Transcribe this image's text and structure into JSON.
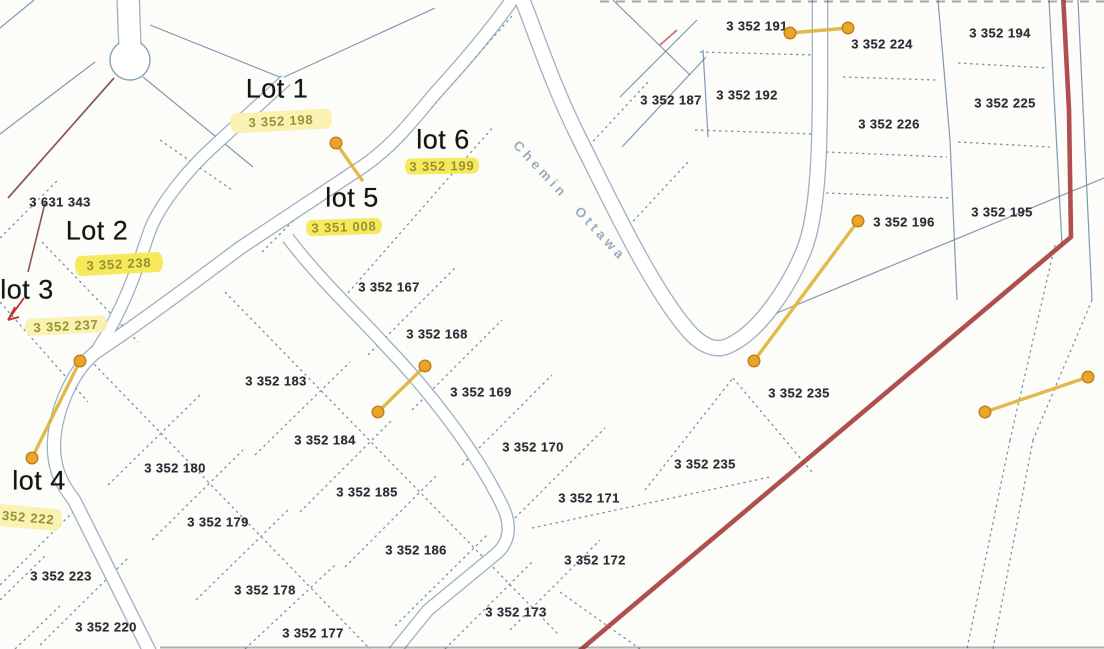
{
  "map": {
    "street_label": "Chemin Ottawa",
    "lot_labels": [
      {
        "text": "Lot 1",
        "x": 277,
        "y": 89
      },
      {
        "text": "Lot 2",
        "x": 97,
        "y": 231
      },
      {
        "text": "lot 3",
        "x": 27,
        "y": 290
      },
      {
        "text": "lot 4",
        "x": 39,
        "y": 481
      },
      {
        "text": "lot 5",
        "x": 352,
        "y": 198
      },
      {
        "text": "lot 6",
        "x": 443,
        "y": 140
      }
    ],
    "highlighted_parcels": [
      {
        "id": "3 352 198",
        "x": 281,
        "y": 121,
        "w": 102,
        "h": 20,
        "tone": "pale",
        "angle": -3
      },
      {
        "id": "3 352 199",
        "x": 442,
        "y": 166,
        "w": 74,
        "h": 16,
        "tone": "bright",
        "angle": -1
      },
      {
        "id": "3 351 008",
        "x": 344,
        "y": 227,
        "w": 76,
        "h": 16,
        "tone": "bright",
        "angle": -2
      },
      {
        "id": "3 352 238",
        "x": 119,
        "y": 264,
        "w": 88,
        "h": 20,
        "tone": "bright",
        "angle": -3
      },
      {
        "id": "3 352 237",
        "x": 66,
        "y": 325,
        "w": 82,
        "h": 17,
        "tone": "pale",
        "angle": -3
      },
      {
        "id": "3 352 222",
        "x": 22,
        "y": 517,
        "w": 80,
        "h": 22,
        "tone": "pale",
        "angle": 5
      }
    ],
    "parcel_labels": [
      {
        "id": "3 631 343",
        "x": 60,
        "y": 202
      },
      {
        "id": "3 352 187",
        "x": 671,
        "y": 100
      },
      {
        "id": "3 352 191",
        "x": 757,
        "y": 26
      },
      {
        "id": "3 352 224",
        "x": 882,
        "y": 44
      },
      {
        "id": "3 352 194",
        "x": 1000,
        "y": 33
      },
      {
        "id": "3 352 192",
        "x": 747,
        "y": 95
      },
      {
        "id": "3 352 225",
        "x": 1005,
        "y": 103
      },
      {
        "id": "3 352 226",
        "x": 889,
        "y": 124
      },
      {
        "id": "3 352 196",
        "x": 904,
        "y": 222
      },
      {
        "id": "3 352 195",
        "x": 1002,
        "y": 212
      },
      {
        "id": "3 352 167",
        "x": 389,
        "y": 287
      },
      {
        "id": "3 352 168",
        "x": 437,
        "y": 334
      },
      {
        "id": "3 352 169",
        "x": 481,
        "y": 392
      },
      {
        "id": "3 352 183",
        "x": 276,
        "y": 381
      },
      {
        "id": "3 352 235",
        "x": 799,
        "y": 393
      },
      {
        "id": "3 352 184",
        "x": 325,
        "y": 440
      },
      {
        "id": "3 352 170",
        "x": 533,
        "y": 447
      },
      {
        "id": "3 352 235",
        "x": 705,
        "y": 464
      },
      {
        "id": "3 352 180",
        "x": 175,
        "y": 468
      },
      {
        "id": "3 352 185",
        "x": 367,
        "y": 492
      },
      {
        "id": "3 352 171",
        "x": 589,
        "y": 498
      },
      {
        "id": "3 352 179",
        "x": 218,
        "y": 522
      },
      {
        "id": "3 352 186",
        "x": 416,
        "y": 550
      },
      {
        "id": "3 352 172",
        "x": 595,
        "y": 560
      },
      {
        "id": "3 352 223",
        "x": 61,
        "y": 576
      },
      {
        "id": "3 352 178",
        "x": 265,
        "y": 590
      },
      {
        "id": "3 352 173",
        "x": 516,
        "y": 612
      },
      {
        "id": "3 352 220",
        "x": 106,
        "y": 627
      },
      {
        "id": "3 352 177",
        "x": 313,
        "y": 633
      }
    ],
    "pins": [
      {
        "x1": 336,
        "y1": 143,
        "x2": 362,
        "y2": 180,
        "double": false
      },
      {
        "x1": 425,
        "y1": 366,
        "x2": 378,
        "y2": 412,
        "double": true
      },
      {
        "x1": 80,
        "y1": 361,
        "x2": 32,
        "y2": 458,
        "double": true
      },
      {
        "x1": 790,
        "y1": 33,
        "x2": 848,
        "y2": 28,
        "double": true
      },
      {
        "x1": 858,
        "y1": 221,
        "x2": 754,
        "y2": 361,
        "double": true
      },
      {
        "x1": 1088,
        "y1": 377,
        "x2": 985,
        "y2": 412,
        "double": true
      }
    ],
    "colors": {
      "highlight_bright": "#f6e84f",
      "highlight_pale": "#faf2ad",
      "highlight_text": "#8e8a25",
      "parcel_text": "#2c2c36",
      "lot_text": "#141414",
      "street_text": "#86a1b9",
      "pin_fill": "#eaa62a",
      "pin_edge": "#c07f18",
      "pin_line": "#dfb23a",
      "boundary_red": "#a84040",
      "map_line": "#6b88a6"
    }
  }
}
